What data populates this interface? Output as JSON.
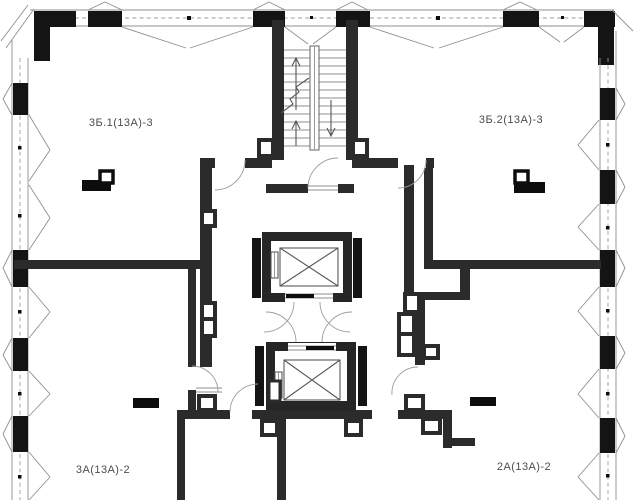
{
  "colors": {
    "wall": "#2b2b2b",
    "pier": "#141414",
    "room_highlight": "#b5b5b5",
    "thin_line": "#8f8f8f",
    "label_text": "#4d4d4d",
    "background": "#ffffff"
  },
  "rooms": [
    {
      "id": "3b1",
      "label": "3Б.1(13А)-3",
      "highlighted": false
    },
    {
      "id": "3b2",
      "label": "3Б.2(13А)-3",
      "highlighted": false
    },
    {
      "id": "3a",
      "label": "3А(13А)-2",
      "highlighted": true
    },
    {
      "id": "2a",
      "label": "2А(13А)-2",
      "highlighted": false
    }
  ],
  "core": {
    "elevator_count": 2,
    "has_staircase": true
  }
}
